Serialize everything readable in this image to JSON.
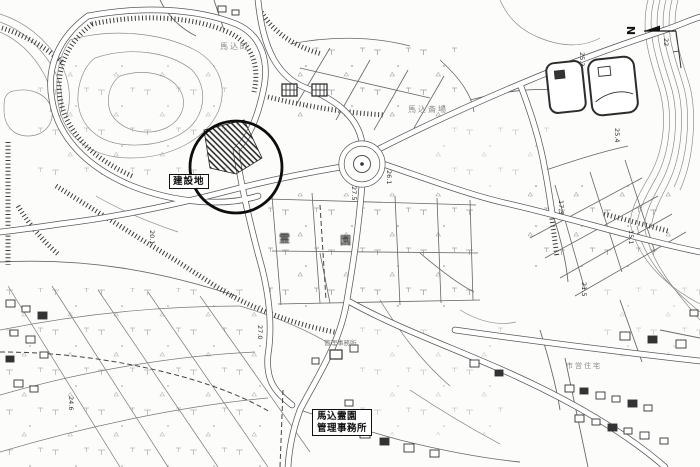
{
  "map": {
    "construction_label": "建設地",
    "office_label": {
      "line1": "馬込霊園",
      "line2": "管理事務所"
    },
    "north_label": "N",
    "spot_elevations": {
      "e1": "26.1",
      "e2": "27.5",
      "e3": "25.4",
      "e4": "17.3",
      "e5": "15.1",
      "e6": "21.5",
      "e7": "24.6",
      "e8": "20.1",
      "e9": "27.0",
      "e10": "25.3",
      "e11": "22"
    },
    "tiny_labels": {
      "office_site": "管理事務所",
      "cemetery_char1": "霊",
      "cemetery_char2": "園",
      "crematorium": "馬込斎場",
      "district": "馬込町",
      "housing": "市営住宅"
    },
    "colors": {
      "paper": "#fcfcfa",
      "ink": "#3f3f3f",
      "light_ink": "#8a8a8a",
      "marker": "#111111"
    }
  }
}
